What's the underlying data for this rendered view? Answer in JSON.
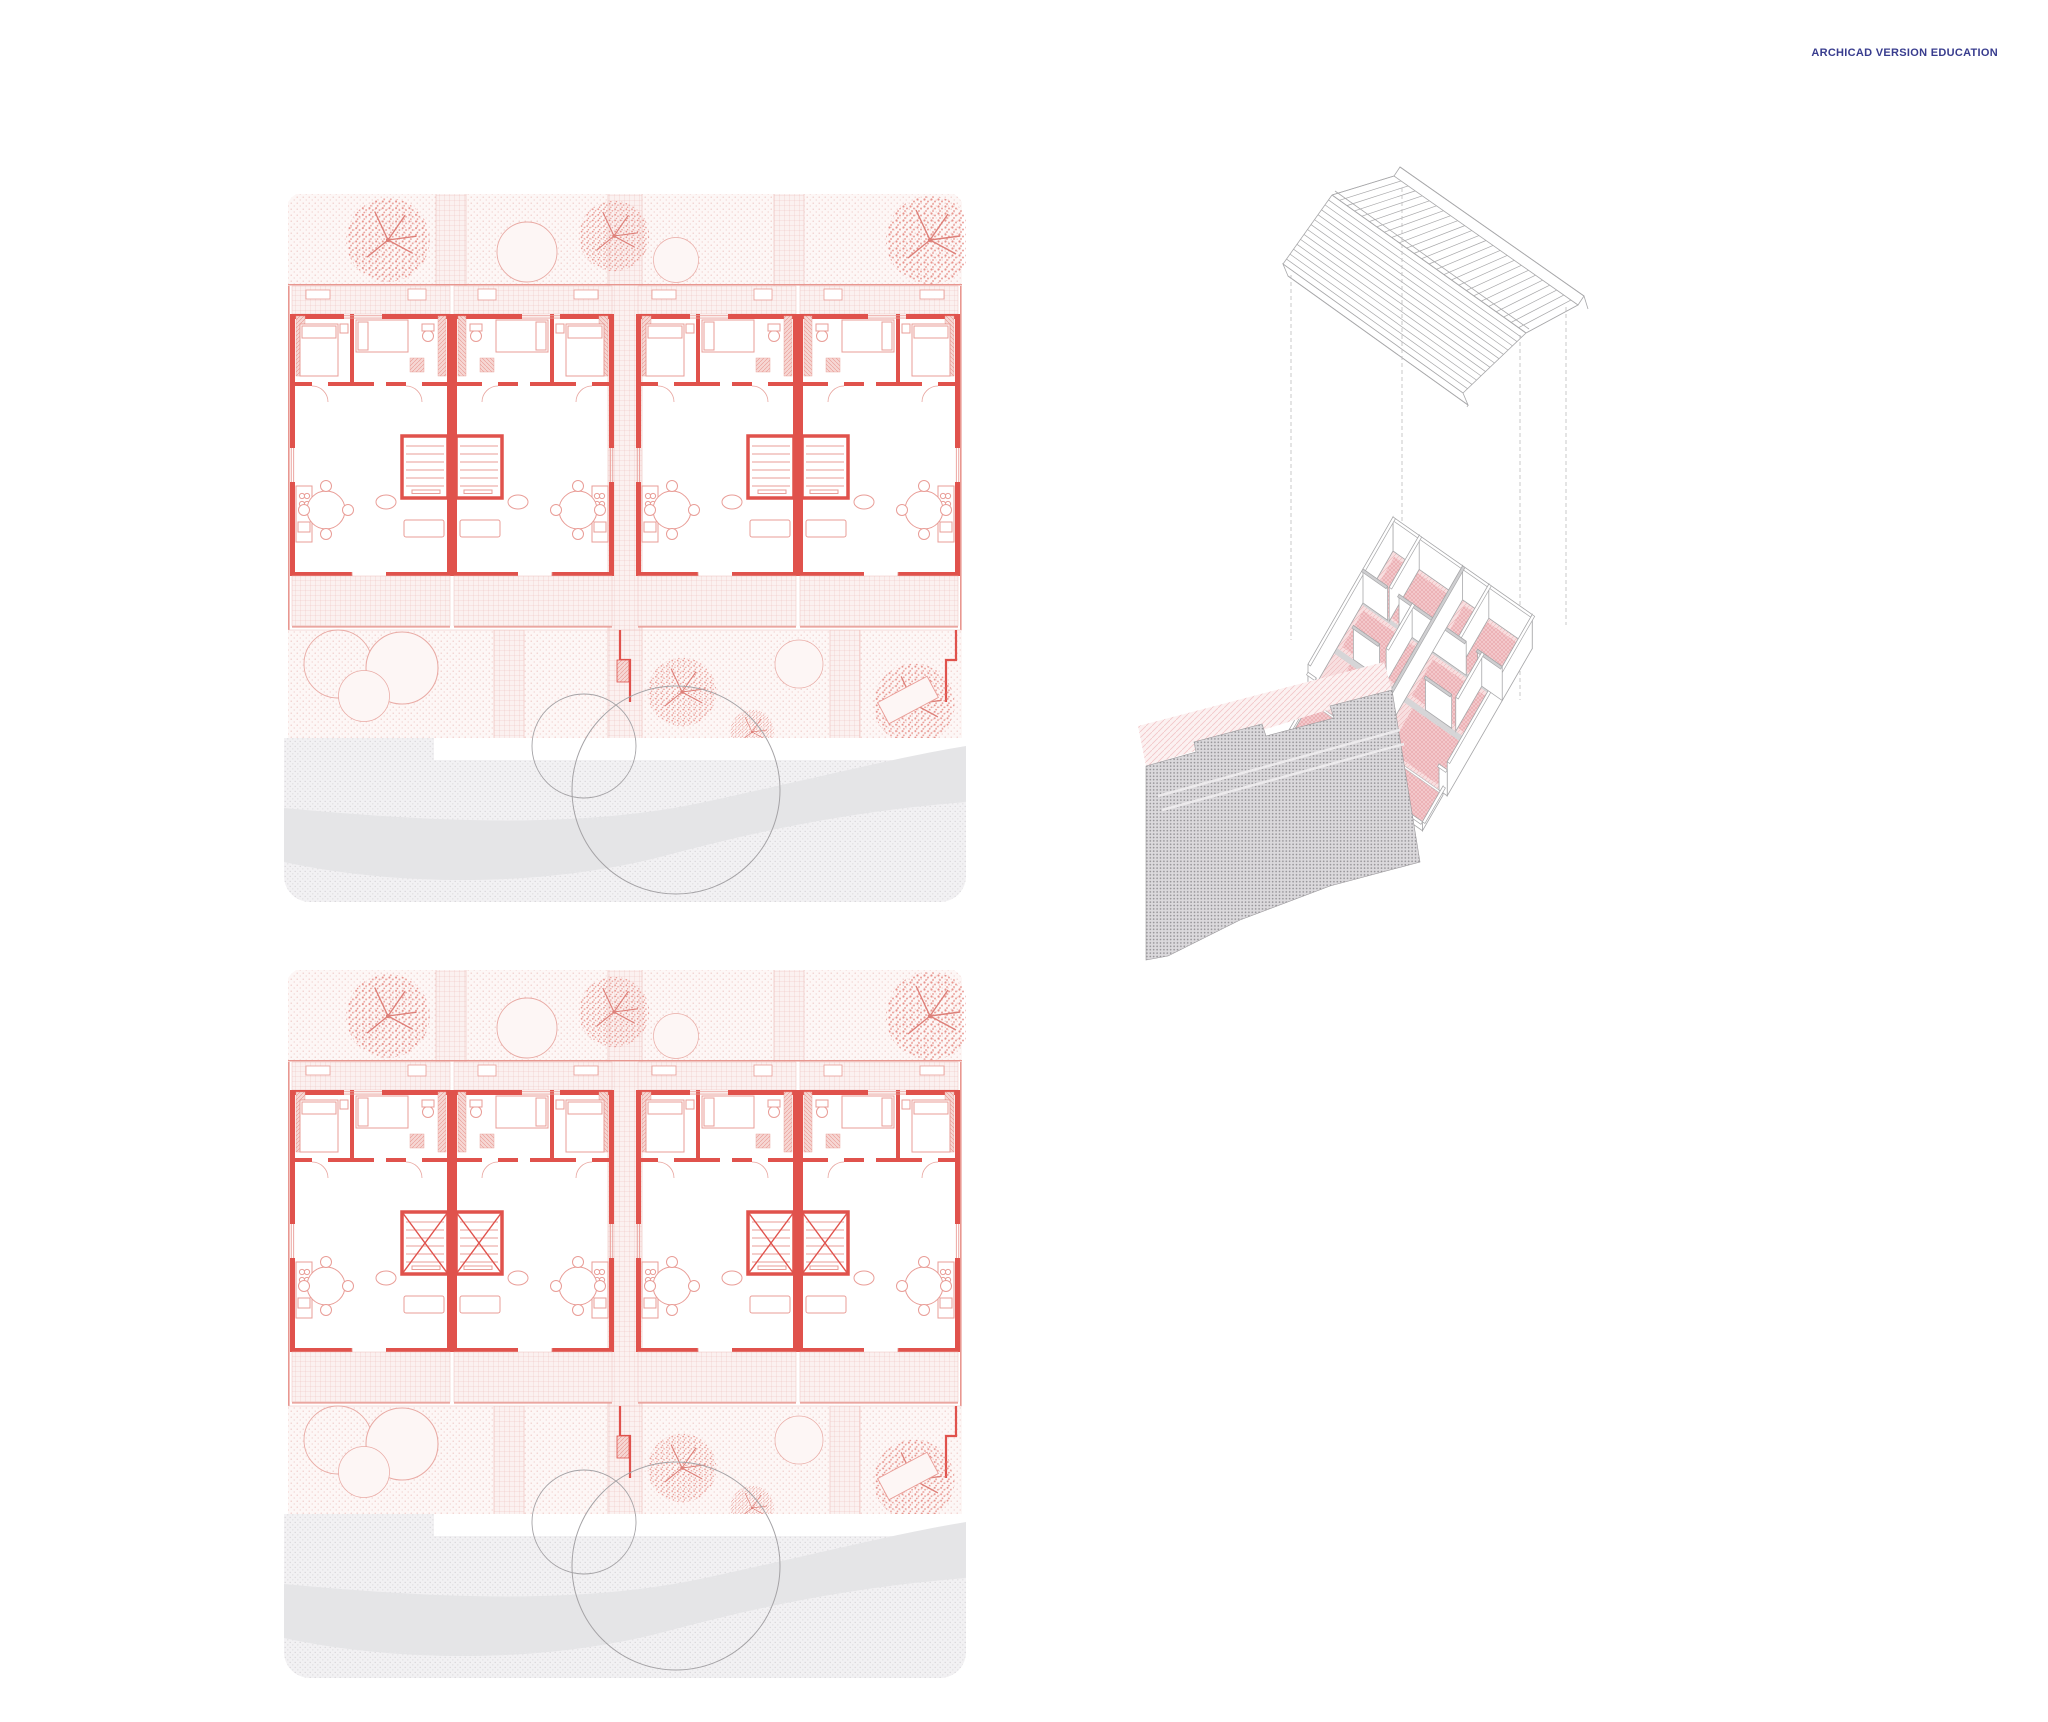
{
  "watermark": {
    "text": "ARCHICAD VERSION EDUCATION",
    "color": "#383c8e"
  },
  "palette": {
    "wall_red": "#e0524c",
    "furniture_pink": "#e99d97",
    "hatch_pink": "#edbfbb",
    "garden_dot": "#eec6c2",
    "tree_speckle": "#e8948d",
    "road_gray": "#e5e5e7",
    "stipple_gray": "#d7d5d8",
    "axon_line": "#a8a8aa",
    "axon_floor_pink": "#f3c8cb",
    "axon_road_dot": "#918f93"
  },
  "drawing": {
    "plans": [
      {
        "id": "upper-floor-plan",
        "units": 4
      },
      {
        "id": "ground-floor-plan",
        "units": 4
      }
    ],
    "axonometric": {
      "id": "exploded-axonometric",
      "parts": [
        "roof",
        "walls-floor",
        "road"
      ]
    }
  }
}
